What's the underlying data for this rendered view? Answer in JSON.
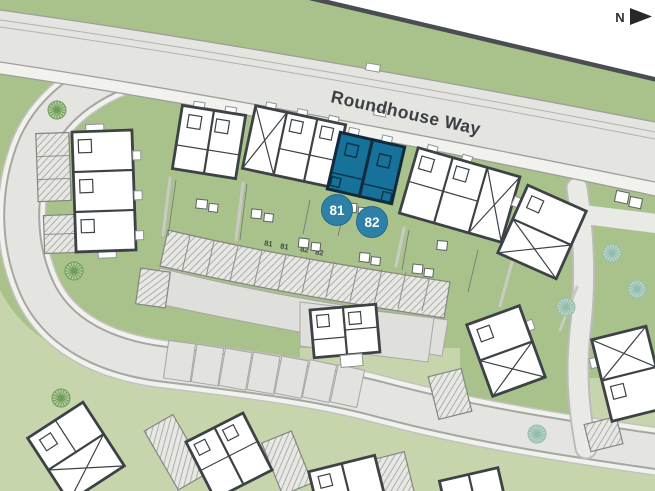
{
  "site_plan": {
    "street_label": "Roundhouse Way",
    "compass": {
      "label": "N"
    },
    "highlighted_plots": [
      {
        "number": "81"
      },
      {
        "number": "82"
      }
    ],
    "parking_bay_labels": [
      "81",
      "81",
      "82",
      "82"
    ],
    "colors": {
      "plot_fill": "#16719b",
      "plot_outline": "#122b3b",
      "badge_fill": "#2e81a6",
      "badge_text": "#ffffff",
      "garden_green": "#a9c28c",
      "garden_green_light": "#c7d5ac",
      "road_grey": "#e4e4e1"
    }
  }
}
